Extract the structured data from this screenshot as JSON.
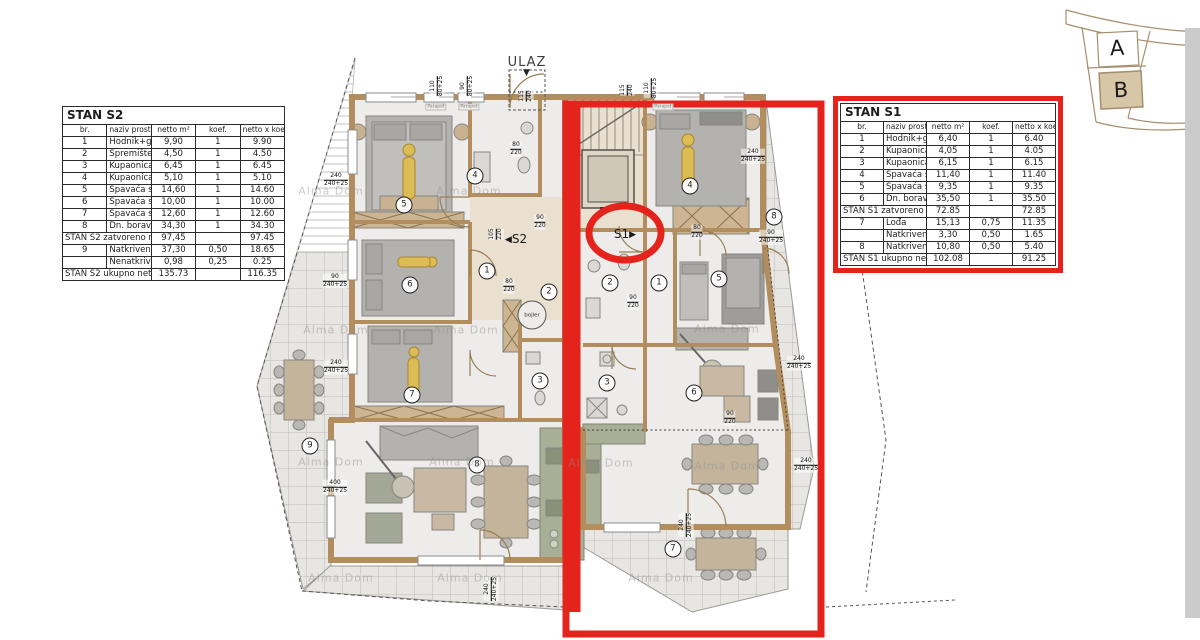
{
  "colors": {
    "highlight_red": "#e3231c",
    "wall_tan": "#b28e5e",
    "kitchen_green": "#a9af97",
    "floor_gray": "#edecea",
    "terrace_gray": "#e7e6e3",
    "site_b_fill": "#d8c7a6",
    "gray_strip": "#cbcbcb"
  },
  "icons": {
    "arrow_left": "◀",
    "arrow_right": "▶",
    "down_arrow": "▼"
  },
  "site_map": {
    "building_a": "A",
    "building_b": "B"
  },
  "tables": {
    "s2": {
      "title": "STAN S2",
      "headers": [
        "br.",
        "naziv prostorije",
        "netto m²",
        "koef.",
        "netto x koef. m²"
      ],
      "rows": [
        [
          "1",
          "Hodnik+garderoba",
          "9,90",
          "1",
          "9.90"
        ],
        [
          "2",
          "Spremište",
          "4,50",
          "1",
          "4.50"
        ],
        [
          "3",
          "Kupaonica",
          "6,45",
          "1",
          "6.45"
        ],
        [
          "4",
          "Kupaonica",
          "5,10",
          "1",
          "5.10"
        ],
        [
          "5",
          "Spavaća soba",
          "14,60",
          "1",
          "14.60"
        ],
        [
          "6",
          "Spavaća soba",
          "10,00",
          "1",
          "10.00"
        ],
        [
          "7",
          "Spavaća soba",
          "12,60",
          "1",
          "12.60"
        ],
        [
          "8",
          "Dn. boravak+kuh.+blag.",
          "34,30",
          "1",
          "34.30"
        ],
        [
          "",
          "STAN S2 zatvoreno neto:",
          "97,45",
          "",
          "97.45"
        ],
        [
          "9",
          "Natkrivena terasa",
          "37,30",
          "0,50",
          "18.65"
        ],
        [
          "",
          "Nenatkrivena terasa",
          "0,98",
          "0,25",
          "0.25"
        ],
        [
          "",
          "STAN S2 ukupno neto:",
          "135.73",
          "",
          "116.35"
        ]
      ]
    },
    "s1": {
      "title": "STAN S1",
      "headers": [
        "br.",
        "naziv prostorije",
        "netto m²",
        "koef.",
        "netto x koef. m²"
      ],
      "rows": [
        [
          "1",
          "Hodnik+garderoba",
          "6,40",
          "1",
          "6.40"
        ],
        [
          "2",
          "Kupaonica",
          "4,05",
          "1",
          "4.05"
        ],
        [
          "3",
          "Kupaonica",
          "6,15",
          "1",
          "6.15"
        ],
        [
          "4",
          "Spavaća soba",
          "11,40",
          "1",
          "11.40"
        ],
        [
          "5",
          "Spavaća soba",
          "9,35",
          "1",
          "9.35"
        ],
        [
          "6",
          "Dn. boravak+kuh.+blag.",
          "35,50",
          "1",
          "35.50"
        ],
        [
          "",
          "STAN S1 zatvoreno neto:",
          "72.85",
          "",
          "72.85"
        ],
        [
          "7",
          "Lođa",
          "15,13",
          "0,75",
          "11.35"
        ],
        [
          "",
          "Natkrivena terasa",
          "3,30",
          "0,50",
          "1.65"
        ],
        [
          "8",
          "Natkrivena terasa",
          "10,80",
          "0,50",
          "5.40"
        ],
        [
          "",
          "STAN S1 ukupno neto:",
          "102.08",
          "",
          "91.25"
        ]
      ]
    }
  },
  "plan": {
    "entrance_label": "ULAZ",
    "unit_s2_label": "S2",
    "unit_s1_label": "S1",
    "bojler_label": "bojler",
    "parapet_label": "Parapet",
    "watermark_text": "Alma Dom",
    "rooms_s2": [
      {
        "n": "1",
        "x": 487,
        "y": 271
      },
      {
        "n": "2",
        "x": 549,
        "y": 292
      },
      {
        "n": "3",
        "x": 540,
        "y": 381
      },
      {
        "n": "4",
        "x": 475,
        "y": 176
      },
      {
        "n": "5",
        "x": 404,
        "y": 205
      },
      {
        "n": "6",
        "x": 410,
        "y": 285
      },
      {
        "n": "7",
        "x": 412,
        "y": 395
      },
      {
        "n": "8",
        "x": 477,
        "y": 465
      },
      {
        "n": "9",
        "x": 310,
        "y": 446
      }
    ],
    "rooms_s1": [
      {
        "n": "1",
        "x": 659,
        "y": 283
      },
      {
        "n": "2",
        "x": 610,
        "y": 283
      },
      {
        "n": "3",
        "x": 607,
        "y": 383
      },
      {
        "n": "4",
        "x": 690,
        "y": 186
      },
      {
        "n": "5",
        "x": 719,
        "y": 279
      },
      {
        "n": "6",
        "x": 694,
        "y": 393
      },
      {
        "n": "7",
        "x": 673,
        "y": 549
      },
      {
        "n": "8",
        "x": 774,
        "y": 217
      }
    ],
    "dims": [
      {
        "t": "110/80+25",
        "x": 437,
        "y": 86,
        "v": 1
      },
      {
        "t": "90/80+25",
        "x": 467,
        "y": 86,
        "v": 1
      },
      {
        "t": "115/240",
        "x": 526,
        "y": 96,
        "v": 1
      },
      {
        "t": "115/240",
        "x": 627,
        "y": 90,
        "v": 1
      },
      {
        "t": "110/80+25",
        "x": 651,
        "y": 88,
        "v": 1
      },
      {
        "t": "240/240+25",
        "x": 336,
        "y": 180,
        "v": 0
      },
      {
        "t": "90/240+25",
        "x": 335,
        "y": 281,
        "v": 0
      },
      {
        "t": "240/240+25",
        "x": 336,
        "y": 367,
        "v": 0
      },
      {
        "t": "400/240+25",
        "x": 335,
        "y": 487,
        "v": 0
      },
      {
        "t": "240/240+25",
        "x": 753,
        "y": 156,
        "v": 0
      },
      {
        "t": "90/240+25",
        "x": 771,
        "y": 237,
        "v": 0
      },
      {
        "t": "240/240+25",
        "x": 799,
        "y": 363,
        "v": 0
      },
      {
        "t": "240/240+25",
        "x": 806,
        "y": 465,
        "v": 0
      },
      {
        "t": "105/220",
        "x": 496,
        "y": 234,
        "v": 1
      },
      {
        "t": "80/220",
        "x": 509,
        "y": 286,
        "v": 0
      },
      {
        "t": "90/220",
        "x": 540,
        "y": 222,
        "v": 0
      },
      {
        "t": "80/220",
        "x": 516,
        "y": 149,
        "v": 0
      },
      {
        "t": "80/220",
        "x": 697,
        "y": 232,
        "v": 0
      },
      {
        "t": "90/220",
        "x": 633,
        "y": 302,
        "v": 0
      },
      {
        "t": "90/220",
        "x": 730,
        "y": 418,
        "v": 0
      },
      {
        "t": "240/240+25",
        "x": 491,
        "y": 589,
        "v": 1
      },
      {
        "t": "240/240+25",
        "x": 686,
        "y": 525,
        "v": 1
      }
    ],
    "window_labels": [
      [
        436,
        107
      ],
      [
        469,
        107
      ],
      [
        663,
        107
      ]
    ],
    "watermarks": [
      [
        331,
        191
      ],
      [
        469,
        191
      ],
      [
        336,
        330
      ],
      [
        466,
        330
      ],
      [
        727,
        329
      ],
      [
        331,
        462
      ],
      [
        462,
        462
      ],
      [
        601,
        463
      ],
      [
        727,
        466
      ],
      [
        341,
        578
      ],
      [
        470,
        578
      ],
      [
        661,
        578
      ]
    ]
  }
}
